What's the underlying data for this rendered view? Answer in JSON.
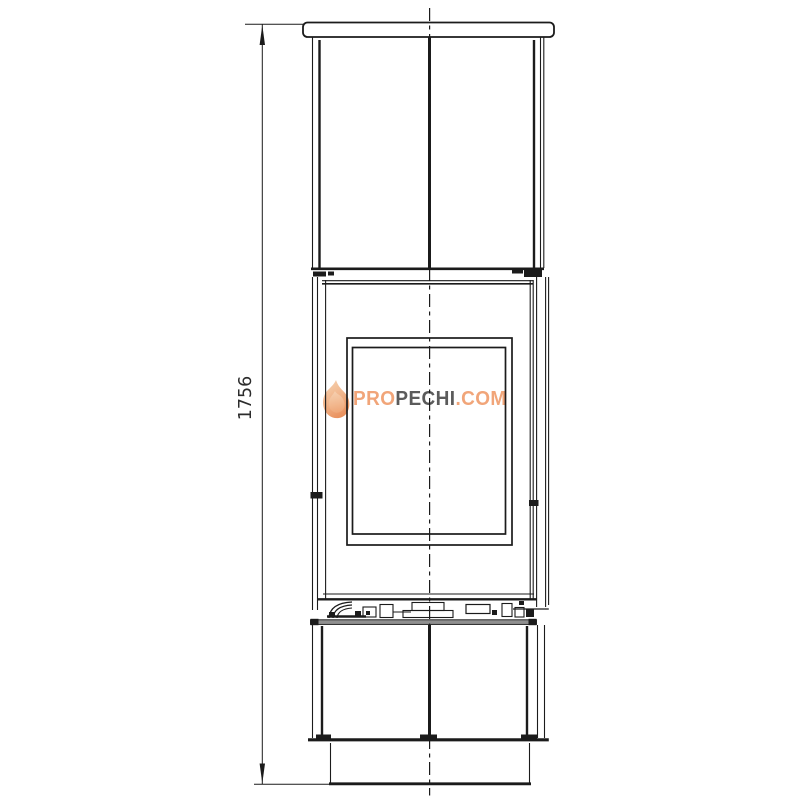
{
  "page": {
    "background": "#ffffff",
    "line_color": "#1b1b1b"
  },
  "dimension": {
    "value_label": "1756"
  },
  "watermark": {
    "icon": "flame-icon",
    "segments": [
      {
        "text": "PRO",
        "color": "#f09e6e"
      },
      {
        "text": "PECHI",
        "color": "#4e4e4e"
      },
      {
        "text": ".COM",
        "color": "#f09e6e"
      }
    ],
    "flame_gradient": [
      "#f6cda9",
      "#eda371",
      "#e8874f"
    ]
  }
}
